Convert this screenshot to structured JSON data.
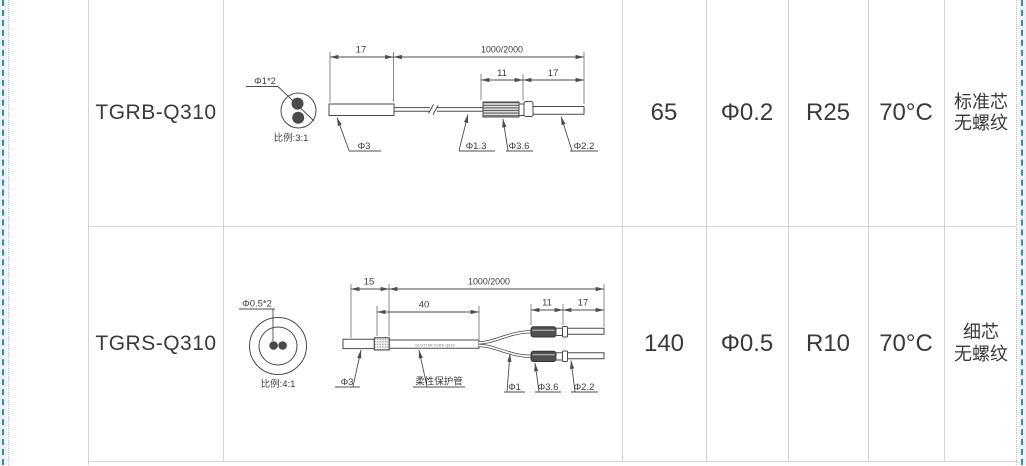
{
  "page": {
    "kind": "fiber-sensor-spec-table",
    "colors": {
      "grid": "#d3d3d3",
      "ink": "#3a3a3a",
      "diagram_stroke": "#4a4a4a",
      "page_break_dash": "#4288a6",
      "page_break_halo": "#e8f4f9",
      "page_break_dot": "#dfaab9"
    }
  },
  "table": {
    "rows": [
      {
        "model": "TGRB-Q310",
        "values": [
          "65",
          "Φ0.2",
          "R25",
          "70°C"
        ],
        "note": [
          "标准芯",
          "无螺纹"
        ],
        "diagram": {
          "cross_section": {
            "label": "Φ1*2",
            "scale": "比例:3:1"
          },
          "dims": {
            "head": "17",
            "cable": "1000/2000",
            "connector": "11",
            "tip": "17"
          },
          "labels": {
            "body": "Φ3",
            "fiber": "Φ1.3",
            "connector": "Φ3.6",
            "tip": "Φ2.2"
          }
        }
      },
      {
        "model": "TGRS-Q310",
        "values": [
          "140",
          "Φ0.5",
          "R10",
          "70°C"
        ],
        "note": [
          "细芯",
          "无螺纹"
        ],
        "diagram": {
          "cross_section": {
            "label": "Φ0.5*2",
            "scale": "比例:4:1"
          },
          "dims": {
            "head": "15",
            "sleeve": "40",
            "cable": "1000/2000",
            "connector": "11",
            "tip": "17"
          },
          "labels": {
            "body": "Φ3",
            "sleeve": "柔性保护管",
            "fiber": "Φ1",
            "connector": "Φ3.6",
            "tip": "Φ2.2"
          },
          "tube_print": "GLOTTER TGRS-Q310"
        }
      }
    ]
  }
}
